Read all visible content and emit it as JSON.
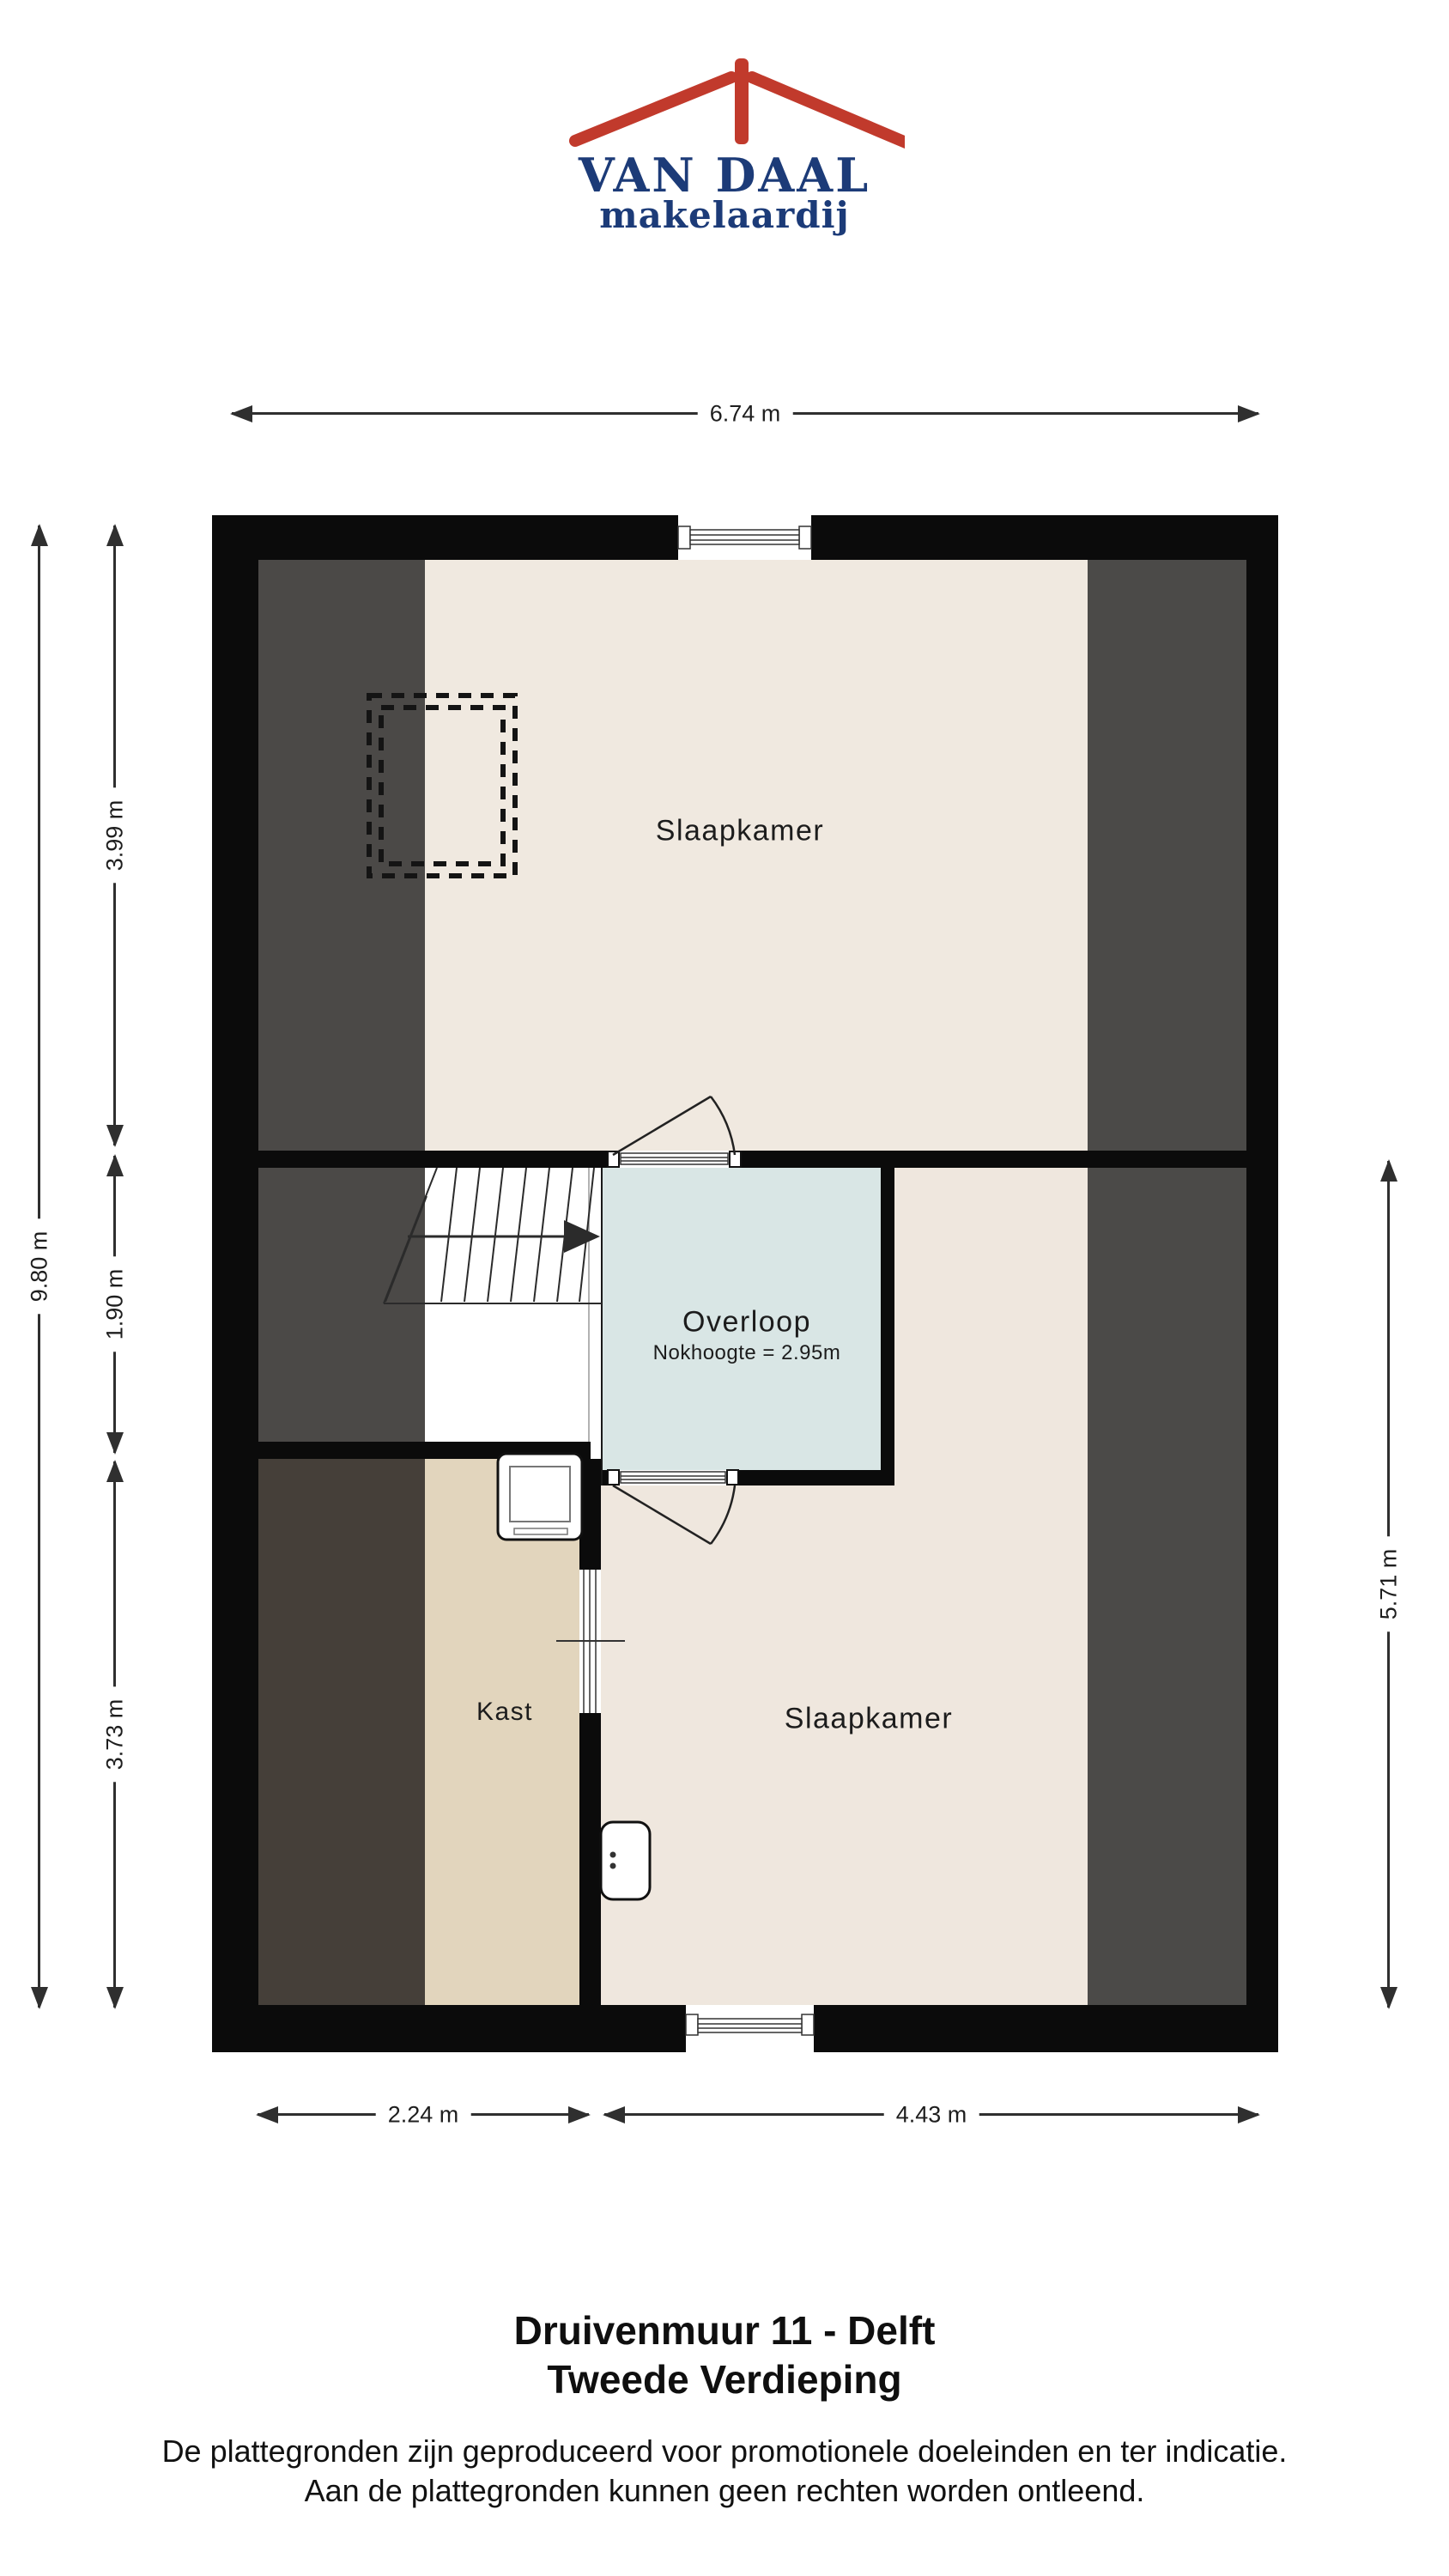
{
  "brand": {
    "name_top": "VAN DAAL",
    "name_bottom": "makelaardij",
    "roof_color": "#c13a2c",
    "text_color": "#1c3b78"
  },
  "plan": {
    "floor_name": "Tweede Verdieping",
    "rooms": {
      "slaapkamer_top": "Slaapkamer",
      "overloop": "Overloop",
      "overloop_note": "Nokhoogte = 2.95m",
      "kast": "Kast",
      "slaapkamer_bottom": "Slaapkamer"
    },
    "colors": {
      "wall": "#0b0b0b",
      "bedroom_floor": "#efe7de",
      "kast_floor": "#e2d5bd",
      "overloop_floor": "#d9e6e5",
      "slope_left_top": "#4b4947",
      "slope_left_bottom": "#453f39",
      "slope_right": "#4b4a48"
    }
  },
  "dimensions": {
    "total_width": "6.74 m",
    "total_height": "9.80 m",
    "left_top": "3.99 m",
    "left_middle": "1.90 m",
    "left_bottom": "3.73 m",
    "right": "5.71 m",
    "bottom_left": "2.24 m",
    "bottom_right": "4.43 m"
  },
  "footer": {
    "title": "Druivenmuur 11 - Delft",
    "subtitle": "Tweede Verdieping",
    "disclaimer_line1": "De plattegronden zijn geproduceerd voor promotionele doeleinden en ter indicatie.",
    "disclaimer_line2": "Aan de plattegronden kunnen geen rechten worden ontleend."
  }
}
